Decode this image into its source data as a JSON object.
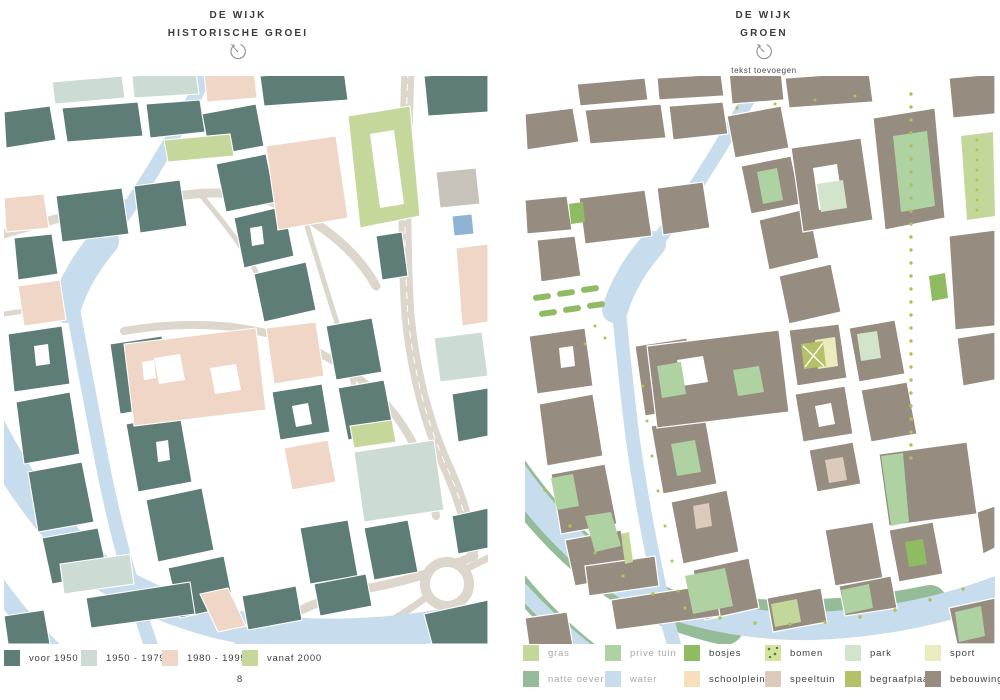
{
  "left_page": {
    "title_line1": "DE WIJK",
    "title_line2": "HISTORISCHE GROEI",
    "history_icon": "history-clock-icon",
    "page_number": "8",
    "legend": [
      {
        "label": "voor 1950",
        "color": "#5d7d76",
        "muted": false
      },
      {
        "label": "1950 - 1979",
        "color": "#cddbd5",
        "muted": false
      },
      {
        "label": "1980 - 1999",
        "color": "#f0d6c6",
        "muted": false
      },
      {
        "label": "vanaf 2000",
        "color": "#c6d79b",
        "muted": false
      }
    ]
  },
  "right_page": {
    "title_line1": "DE WIJK",
    "title_line2": "GROEN",
    "history_icon": "history-clock-icon",
    "subtitle": "tekst toevoegen",
    "legend_row1": [
      {
        "label": "gras",
        "color": "#c3d79a",
        "muted": true,
        "dots": false
      },
      {
        "label": "prive tuin",
        "color": "#aed2a2",
        "muted": true,
        "dots": false
      },
      {
        "label": "bosjes",
        "color": "#8fbb62",
        "muted": false,
        "dots": false
      },
      {
        "label": "bomen",
        "color": "#d4e29b",
        "muted": false,
        "dots": true
      },
      {
        "label": "park",
        "color": "#d2e5cc",
        "muted": false,
        "dots": false
      },
      {
        "label": "sport",
        "color": "#ebecbe",
        "muted": false,
        "dots": false
      }
    ],
    "legend_row2": [
      {
        "label": "natte oever",
        "color": "#95bc98",
        "muted": true,
        "dots": false
      },
      {
        "label": "water",
        "color": "#c7dcec",
        "muted": true,
        "dots": false
      },
      {
        "label": "schoolplein",
        "color": "#f6dfbc",
        "muted": false,
        "dots": false
      },
      {
        "label": "speeltuin",
        "color": "#dccabc",
        "muted": false,
        "dots": false
      },
      {
        "label": "begraafplaats",
        "color": "#b5c167",
        "muted": false,
        "dots": false
      },
      {
        "label": "bebouwing",
        "color": "#968c80",
        "muted": false,
        "dots": false
      }
    ]
  },
  "palette": {
    "water": "#c7dcec",
    "road": "#dcd6cc",
    "building_old": "#5d7d76",
    "building_right_map": "#968c80"
  }
}
